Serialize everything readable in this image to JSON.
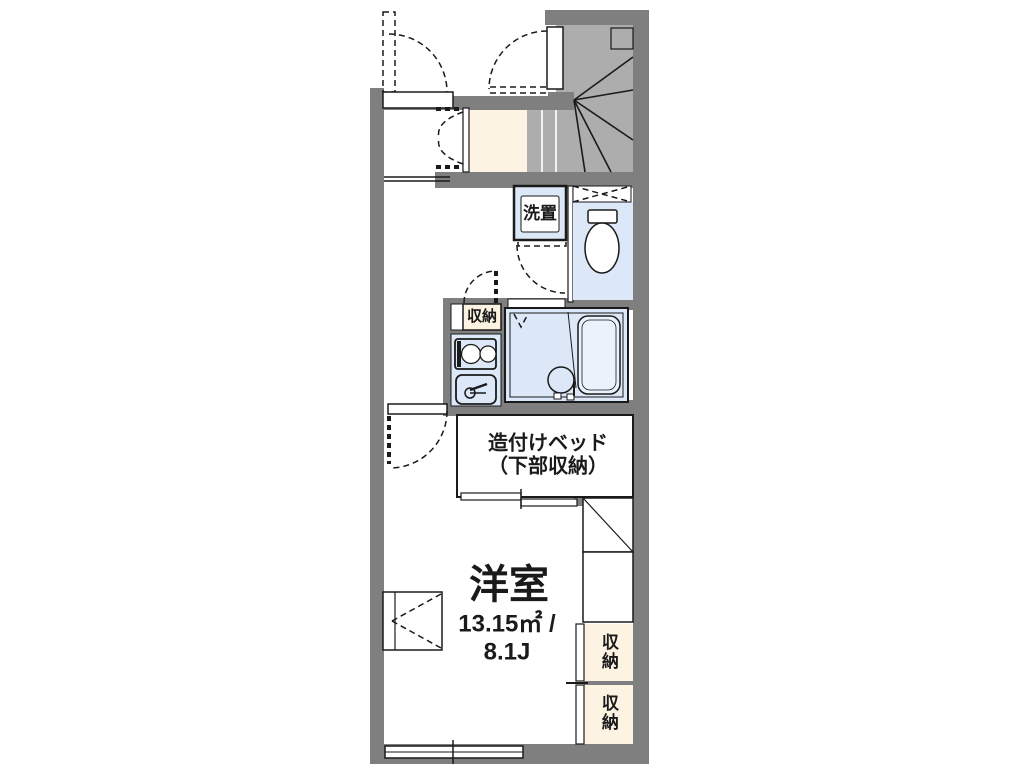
{
  "colors": {
    "wall": "#7f7f7f",
    "stair": "#adadad",
    "cream": "#fdf3e2",
    "blue": "#dce8f8",
    "tub": "#eaf2fb",
    "line": "#1a1a1a"
  },
  "rooms": {
    "washer_label": "洗置",
    "kitchen_storage_label": "収納",
    "bed_label_line1": "造付けベッド",
    "bed_label_line2": "（下部収納）",
    "main_room_name": "洋室",
    "main_room_area": "13.15㎡ /",
    "main_room_size": "8.1J",
    "storage_right_upper_label": "収納",
    "storage_right_lower_label": "収納"
  }
}
